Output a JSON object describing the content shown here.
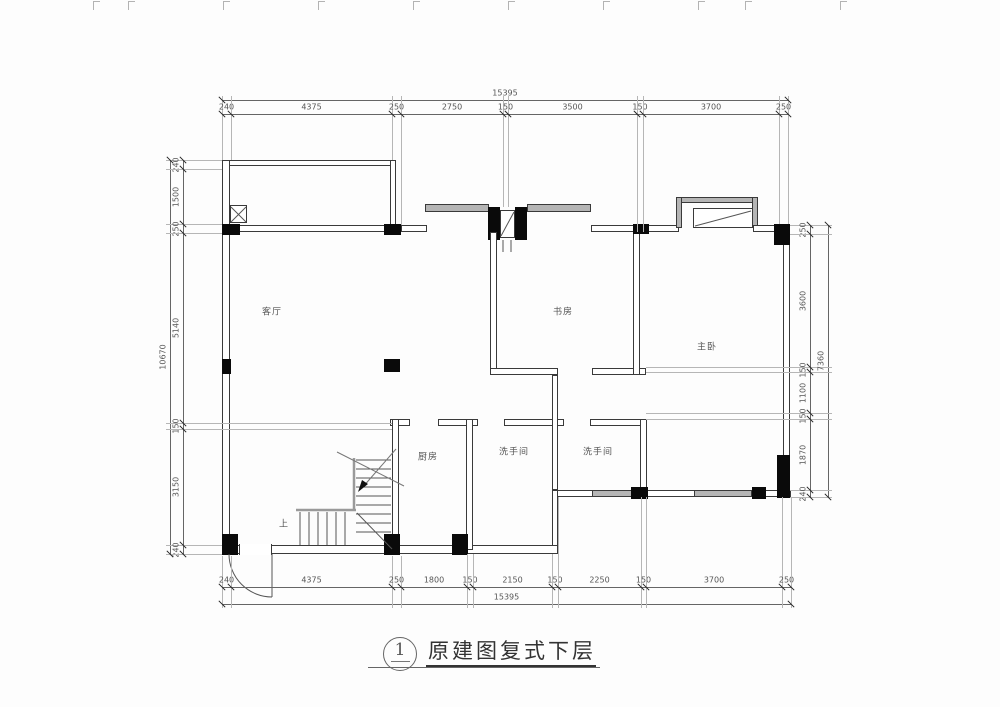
{
  "title": {
    "number": "1",
    "name": "原建图复式下层"
  },
  "rooms": [
    {
      "id": "living-room",
      "label": "客厅"
    },
    {
      "id": "study",
      "label": "书房"
    },
    {
      "id": "master-bedroom",
      "label": "主卧"
    },
    {
      "id": "kitchen",
      "label": "厨房"
    },
    {
      "id": "bathroom-1",
      "label": "洗手间"
    },
    {
      "id": "bathroom-2",
      "label": "洗手间"
    }
  ],
  "stairs": {
    "up_label": "上"
  },
  "dimensions": {
    "top": {
      "total": "15395",
      "segments": [
        "240",
        "4375",
        "250",
        "2750",
        "150",
        "3500",
        "150",
        "3700",
        "250"
      ]
    },
    "bottom": {
      "total": "15395",
      "segments": [
        "240",
        "4375",
        "250",
        "1800",
        "150",
        "2150",
        "150",
        "2250",
        "150",
        "3700",
        "250"
      ]
    },
    "left": {
      "total": "10670",
      "segments": [
        "240",
        "1500",
        "250",
        "5140",
        "150",
        "3150",
        "240"
      ]
    },
    "right": {
      "total": "7360",
      "segments": [
        "250",
        "3600",
        "150",
        "1100",
        "150",
        "1870",
        "240"
      ]
    }
  }
}
